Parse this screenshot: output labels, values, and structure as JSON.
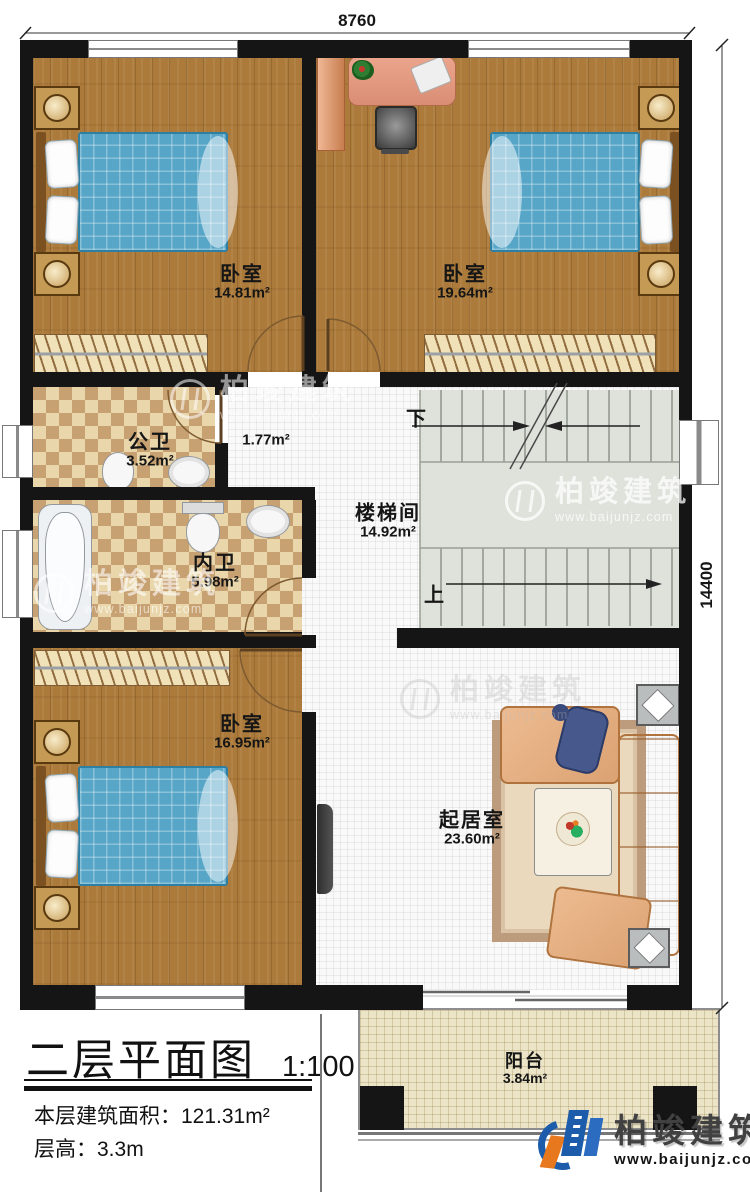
{
  "dimensions": {
    "width": "8760",
    "height": "14400"
  },
  "rooms": {
    "bedroom_top_left": {
      "name": "卧室",
      "area": "14.81m²"
    },
    "bedroom_top_right": {
      "name": "卧室",
      "area": "19.64m²"
    },
    "public_bathroom": {
      "name": "公卫",
      "area": "3.52m²"
    },
    "hallway": {
      "area": "1.77m²"
    },
    "ensuite_bathroom": {
      "name": "内卫",
      "area": "5.98m²"
    },
    "stairwell": {
      "name": "楼梯间",
      "area": "14.92m²"
    },
    "bedroom_bottom_left": {
      "name": "卧室",
      "area": "16.95m²"
    },
    "living_room": {
      "name": "起居室",
      "area": "23.60m²"
    },
    "balcony": {
      "name": "阳台",
      "area": "3.84m²"
    }
  },
  "stairs": {
    "down": "下",
    "up": "上"
  },
  "title_block": {
    "title": "二层平面图",
    "scale": "1:100",
    "area_label": "本层建筑面积：",
    "area_value": "121.31m²",
    "height_label": "层高：",
    "height_value": "3.3m"
  },
  "brand": {
    "name": "柏竣建筑",
    "url": "www.baijunjz.com"
  },
  "watermark": {
    "name": "柏竣建筑",
    "url": "www.baijunjz.com"
  },
  "colors": {
    "wall": "#151515",
    "wood_floor": "#ac7b3b",
    "tile_light": "#e9d6aa",
    "tile_dark": "#c7a171",
    "bed_blue": "#57a6c8",
    "sofa_peach": "#dba272",
    "stair_gray": "#dfe2db",
    "balcony_floor": "#ece4c7",
    "brand_blue": "#1d5cab",
    "brand_orange": "#e8781e"
  }
}
